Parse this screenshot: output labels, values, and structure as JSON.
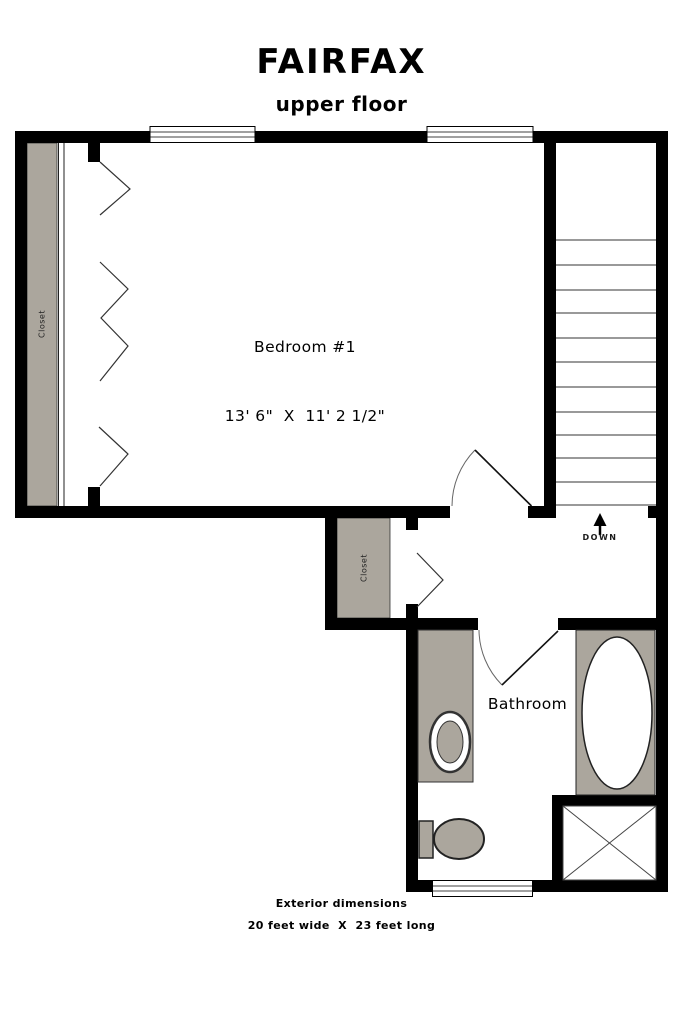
{
  "header": {
    "title": "FAIRFAX",
    "subtitle": "upper floor"
  },
  "labels": {
    "bedroom_name": "Bedroom #1",
    "bedroom_dims": "13' 6\"  X  11' 2 1/2\"",
    "bathroom": "Bathroom",
    "closet_bedroom": "Closet",
    "closet_hall": "Closet",
    "stairs_down": "DOWN"
  },
  "footer": {
    "line1": "Exterior dimensions",
    "line2": "20 feet wide  X  23 feet long"
  },
  "colors": {
    "wall": "#000000",
    "fixture_gray": "#aba69d",
    "stair_tread": "#999999",
    "line_dark": "#333333",
    "background": "#ffffff"
  }
}
